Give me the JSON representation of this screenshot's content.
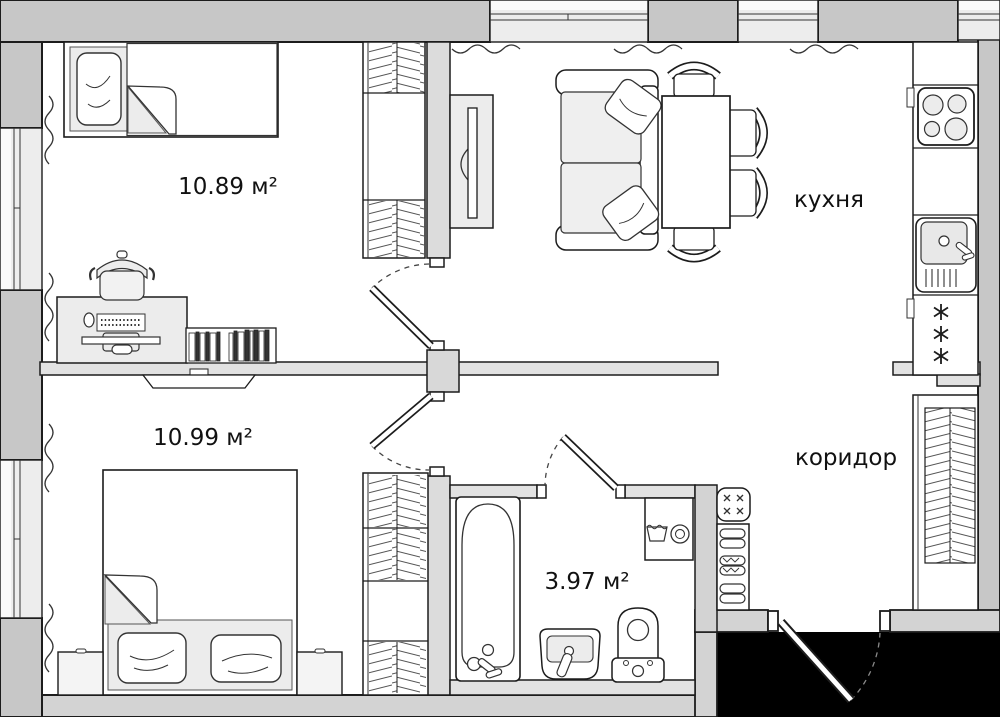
{
  "plan": {
    "type": "apartment-floor-plan",
    "rooms": [
      {
        "id": "bedroom-1",
        "label": "10.89 м²"
      },
      {
        "id": "bedroom-2",
        "label": "10.99 м²"
      },
      {
        "id": "bathroom",
        "label": "3.97 м²"
      },
      {
        "id": "kitchen",
        "label": "кухня"
      },
      {
        "id": "corridor",
        "label": "коридор"
      }
    ],
    "colors": {
      "outer_wall": "#c7c7c7",
      "secondary_wall": "#d3d3d3",
      "inner_wall": "#e2e2e2",
      "furniture_fill": "#ececec",
      "window_pane": "#ededed",
      "entry_void": "#000000",
      "line": "#1c1c1c"
    },
    "icons": [
      "single-bed-icon",
      "double-bed-icon",
      "pillow-icon",
      "desk-icon",
      "office-chair-icon",
      "books-icon",
      "tv-icon",
      "wardrobe-icon",
      "sofa-icon",
      "dining-table-icon",
      "chair-icon",
      "stove-icon",
      "sink-icon",
      "fridge-icon",
      "bathtub-icon",
      "washbasin-icon",
      "toilet-icon",
      "washing-machine-icon",
      "shoe-rack-icon",
      "pouf-icon",
      "radiator-icon",
      "door-swing-icon",
      "window-icon"
    ]
  }
}
